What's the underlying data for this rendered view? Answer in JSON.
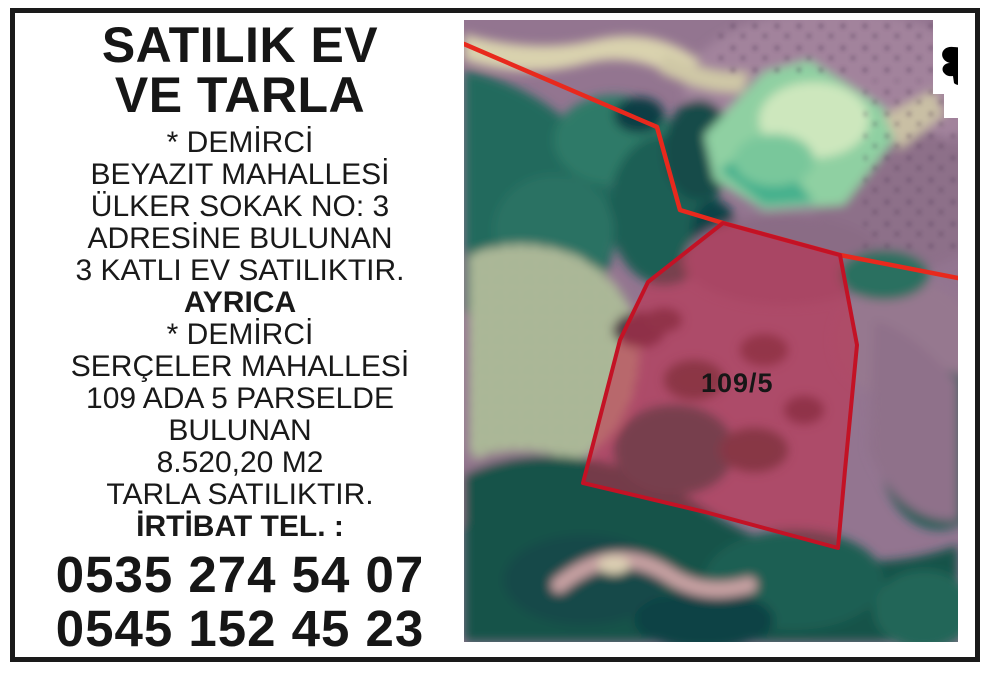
{
  "poster": {
    "title": {
      "line1": "SATILIK EV",
      "line2": "VE TARLA"
    },
    "lines": [
      {
        "text": "* DEMİRCİ"
      },
      {
        "text": "BEYAZIT MAHALLESİ"
      },
      {
        "text": "ÜLKER SOKAK NO: 3"
      },
      {
        "text": "ADRESİNE BULUNAN"
      },
      {
        "text": "3 KATLI EV SATILIKTIR."
      },
      {
        "text": "AYRICA"
      },
      {
        "text": "* DEMİRCİ"
      },
      {
        "text": "SERÇELER MAHALLESİ"
      },
      {
        "text": "109 ADA 5 PARSELDE"
      },
      {
        "text": "BULUNAN"
      },
      {
        "text": "8.520,20 M2"
      },
      {
        "text": "TARLA SATILIKTIR."
      },
      {
        "text": "İRTİBAT TEL. :"
      }
    ],
    "phones": [
      "0535 274 54 07",
      "0545 152 45 23"
    ]
  },
  "map": {
    "parcel_label": "109/5",
    "colors": {
      "boundary_red": "#e8291d",
      "parcel_stroke": "#c31225",
      "parcel_fill": "#c32848",
      "label": "#161616"
    }
  }
}
